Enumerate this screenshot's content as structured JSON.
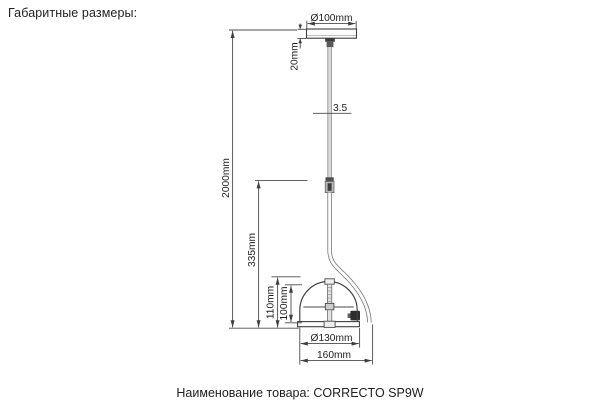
{
  "header": {
    "title": "Габаритные размеры:"
  },
  "footer": {
    "label": "Наименование товара:",
    "product": "CORRECTO SP9W"
  },
  "drawing": {
    "subject": "pendant-lamp-dimension-drawing",
    "dimensions": {
      "canopy_diameter": "Ø100mm",
      "canopy_height": "20mm",
      "cable_diameter": "3.5",
      "suspension_length": "2000mm",
      "drop_to_shade": "335mm",
      "shade_outer_height": "110mm",
      "shade_inner_height": "100mm",
      "shade_diameter": "Ø130mm",
      "overall_width": "160mm"
    },
    "colors": {
      "line": "#3f3f3f",
      "dimension_line": "#4b4b4b",
      "text": "#1c1c1c",
      "metal_light": "#d9d9d9",
      "metal_dark": "#4a4a4a"
    }
  }
}
